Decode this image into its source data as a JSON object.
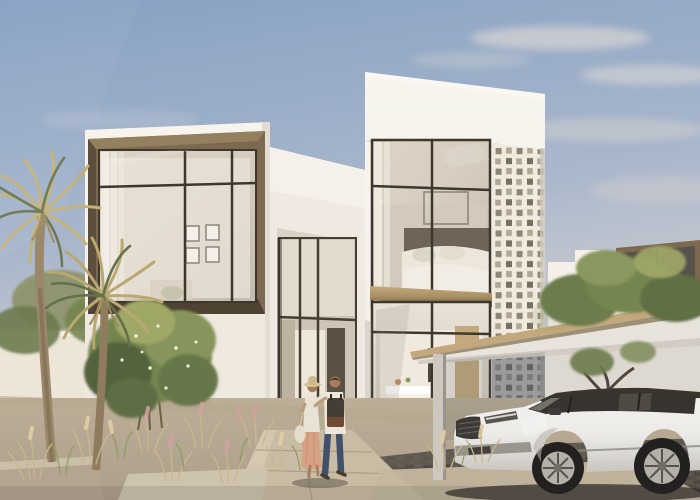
{
  "scene": {
    "description": "Architectural rendering of a modern white two-storey villa with bronze-framed floor-to-ceiling windows, a perforated mashrabiya screen, a carport canopy sheltering a white luxury SUV, palm trees and desert grasses, and a couple walking toward the entrance under a soft blue sky",
    "objects": [
      "sky",
      "clouds",
      "palm-trees",
      "garden-wall",
      "villa-left-wing",
      "bronze-window-box",
      "entry-recess",
      "right-tower",
      "bedroom-window",
      "brass-spandrel",
      "kitchen-window",
      "perforated-screen",
      "neighbor-house",
      "trees",
      "carport-canopy",
      "carport-post",
      "suv-car",
      "walking-couple",
      "shrub",
      "grasses",
      "walkway",
      "driveway"
    ],
    "time_of_day": "late afternoon warm light",
    "people_count": 2,
    "vehicle": "white luxury SUV"
  },
  "palette": {
    "sky_top": "#87a1c3",
    "sky_mid": "#a9b7cc",
    "sky_horizon": "#d8d4d1",
    "cloud": "#e9e1d7",
    "wall_white": "#f3efe9",
    "wall_shade": "#e4ded5",
    "wall_recess": "#e9e2d8",
    "bronze_frame": "#7c6950",
    "bronze_dark": "#463e33",
    "brass": "#a98f63",
    "glass_warm": "#d6ccbf",
    "glass_cool": "#e8e2d7",
    "screen_base": "#f1ebdf",
    "screen_hole": "#8d8474",
    "canopy_wood": "#c2a87c",
    "canopy_white": "#efebe4",
    "foliage_dark": "#53643e",
    "foliage_mid": "#74854f",
    "foliage_light": "#a0a868",
    "palm_gold": "#c4b277",
    "trunk": "#9b8769",
    "grass_tan": "#c8b78d",
    "plume_pink": "#d2a2a2",
    "ground_sand": "#ac9f8b",
    "paver": "#c9bca4",
    "cobble": "#575149",
    "car_body": "#eceae7",
    "car_roof": "#3a342c",
    "tire": "#23211f",
    "rim": "#b5b1aa",
    "skin": "#c09873",
    "skirt_peach": "#d7a184",
    "jeans_blue": "#41506b",
    "backpack": "#453e36",
    "hat_straw": "#d8c399"
  }
}
